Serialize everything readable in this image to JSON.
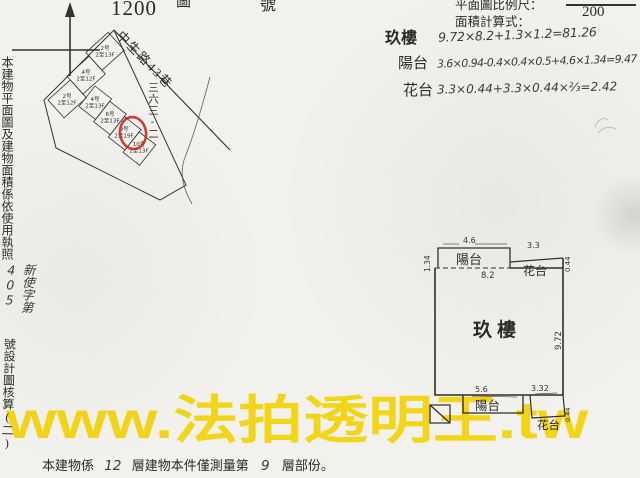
{
  "doc": {
    "paper_color": "#f2f1ed",
    "ink_color": "#2b2a27",
    "accent_red": "#c9271d",
    "watermark_color": "#ffe10a"
  },
  "header": {
    "map_scale": "1200",
    "fragment_left": "圖",
    "fragment_right": "號",
    "scale_label": "平面圖比例尺：",
    "scale_value": "200",
    "area_label": "面積計算式：",
    "calculations": [
      {
        "label": "玖樓",
        "formula": "9.72×8.2+1.3×1.2=81.26"
      },
      {
        "label": "陽台",
        "formula": "3.6×0.94-0.4×0.4×0.5+4.6×1.34=9.47"
      },
      {
        "label": "花台",
        "formula": "3.3×0.44+3.3×0.44×⅔=2.42"
      }
    ]
  },
  "margin_note": {
    "printed": "本建物平面圖及建物面積係依使用執照",
    "handwritten": "新使字第405",
    "printed_tail": "號設計圖核算(二)"
  },
  "site_map": {
    "street_name": "中生路43巷",
    "lot_number": "三六三-二",
    "units_upper": [
      {
        "no": "2号",
        "floors": "2至12F"
      },
      {
        "no": "4号",
        "floors": "2至12F"
      },
      {
        "no": "2号",
        "floors": "2至13F"
      }
    ],
    "units_lower": [
      {
        "no": "4号",
        "floors": "2至13F"
      },
      {
        "no": "6号",
        "floors": "2至13F"
      },
      {
        "no": "9号",
        "floors": "2至19F"
      },
      {
        "no": "10号",
        "floors": "2至13F"
      }
    ]
  },
  "floor_plan": {
    "room_label": "玖樓",
    "balcony_top_label": "陽台",
    "flower_top_label": "花台",
    "balcony_bottom_label": "陽台",
    "flower_bottom_label": "花台",
    "dim_top_balcony_width": "4.6",
    "dim_top_balcony_depth": "1.34",
    "dim_room_width": "8.2",
    "dim_flower_top_width": "3.3",
    "dim_flower_top_depth": "0.44",
    "dim_room_height": "9.72",
    "dim_bottom_balcony_width": "5.6",
    "dim_bottom_flower_width": "3.32",
    "dim_bottom_flower_depth": "0.44"
  },
  "footer": {
    "part1": "本建物係",
    "hand_floors": "12",
    "part2": "層建物本件僅測量第",
    "hand_floor": "9",
    "part3": "層部份。"
  },
  "watermark": {
    "text": "www.法拍透明王.tw"
  }
}
